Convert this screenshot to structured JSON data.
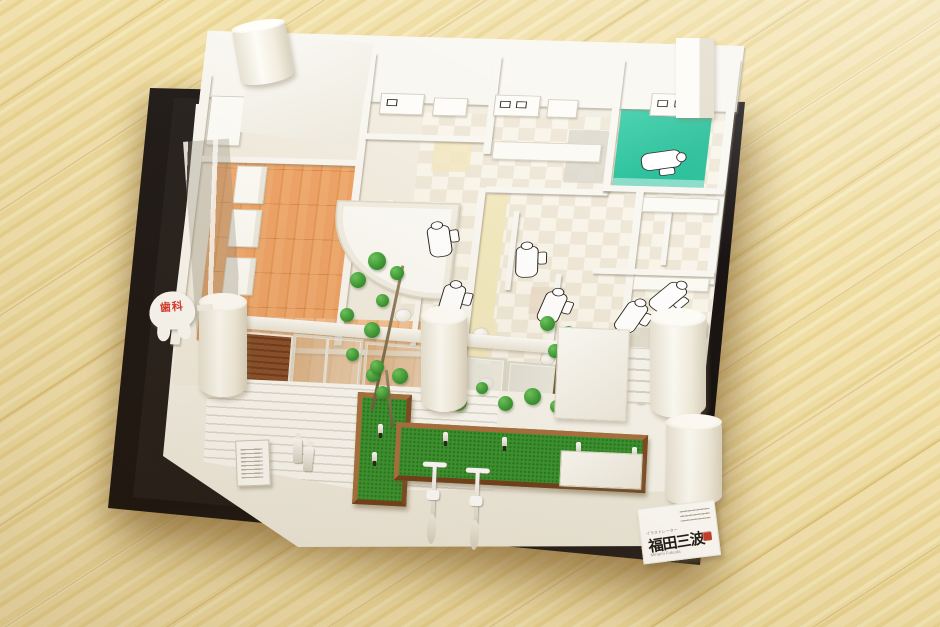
{
  "photo": {
    "subject": "Architectural scale model of a dental clinic on a black display base, photographed on a pale pine wood floor",
    "tooth_sign": {
      "text": "歯科",
      "text_color": "#d5382b"
    },
    "maker_card": {
      "role_label": "イラストレーター",
      "name_calligraphy": "福田三波",
      "name_roman": "Minami Fukuda",
      "seal_color": "#c23f2c"
    },
    "colors": {
      "wood_floor": "#f0dfa6",
      "base_black": "#1a1615",
      "board_white": "#f4f1e8",
      "interior_wood_floor": "#eca468",
      "teal_room_floor": "#2fc7a3",
      "garden_green": "#3b9231",
      "planter_brown": "#96613a",
      "wood_slat_panel": "#8a4f2b"
    }
  }
}
